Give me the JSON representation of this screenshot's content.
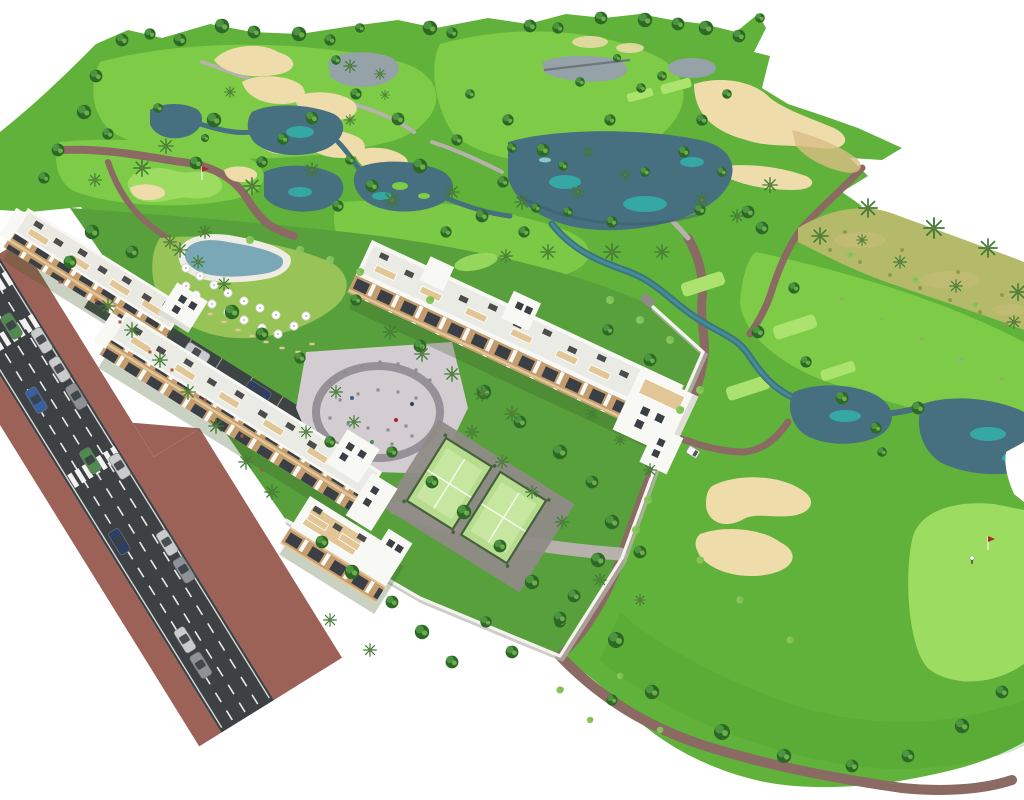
{
  "meta": {
    "description": "Aerial 3D architectural rendering of a white apartment resort complex with pool, playground and padel courts beside a golf course with lakes, sand bunkers, palm trees and an access road with cars"
  },
  "colors": {
    "bg": "#ffffff",
    "grassBase": "#61b23a",
    "grassLight": "#7ecb47",
    "grassPale": "#9cdc60",
    "tee": "#abe36e",
    "grassDark": "#4a9a2f",
    "grassComplex": "#57a03c",
    "lawnYellow": "#a3c95c",
    "scrub": "#b4ba6a",
    "scrubDark": "#8d9a4d",
    "lake": "#46707f",
    "lakeDark": "#3a5c6d",
    "lakeTeal": "#35a7a4",
    "lakeLight": "#86ccc9",
    "pondGray": "#95a3a8",
    "sand": "#eedcab",
    "sandDark": "#d9bd85",
    "path": "#8a6a63",
    "pathGray": "#b7b1ac",
    "road": "#3d4144",
    "roadLine": "#f2f2f0",
    "sidewalk": "#9c6257",
    "bld": "#f8f8f4",
    "bldShade": "#deded6",
    "balconyTan": "#c59c6e",
    "balconyLight": "#e3c695",
    "glass": "#3a3f45",
    "roofItem": "#4c4c4a",
    "wall": "#f4f3ee",
    "wallShadow": "#b9b8b0",
    "pave": "#d3ccd1",
    "paveArc": "#8f8a91",
    "paveDark": "#8f8b86",
    "padel": "#b7dc8d",
    "padelLight": "#cdeaa8",
    "fence": "#44603e",
    "pool": "#7ba8b6",
    "deck": "#efece3",
    "shadow": "rgba(60,90,40,0.28)",
    "treeDark": "#2d6827",
    "treeMid": "#4c9440",
    "treeLight": "#7cbf53",
    "palm": "#3e7c33",
    "trunk": "#8a6b4a",
    "bush": "#8ac45d",
    "carSilver": "#c9cbcd",
    "carGray": "#8e9296",
    "carBlue": "#3a5f9e",
    "carDarkBlue": "#2e3f63",
    "carGreen": "#4f8a4e",
    "cartWhite": "#fafafa",
    "flag": "#a32c24",
    "figure": "#a85a3c",
    "speck": "#8d8894",
    "bridge": "#70757a"
  },
  "scene": {
    "trees_round": [
      [
        122,
        40,
        0.8
      ],
      [
        150,
        34,
        0.7
      ],
      [
        180,
        40,
        0.8
      ],
      [
        222,
        26,
        0.9
      ],
      [
        254,
        32,
        0.8
      ],
      [
        299,
        34,
        0.9
      ],
      [
        330,
        40,
        0.7
      ],
      [
        360,
        28,
        0.6
      ],
      [
        430,
        28,
        0.9
      ],
      [
        452,
        33,
        0.7
      ],
      [
        530,
        26,
        0.8
      ],
      [
        558,
        28,
        0.7
      ],
      [
        601,
        18,
        0.8
      ],
      [
        645,
        20,
        0.9
      ],
      [
        678,
        24,
        0.8
      ],
      [
        706,
        28,
        0.9
      ],
      [
        739,
        36,
        0.8
      ],
      [
        760,
        18,
        0.6
      ],
      [
        96,
        76,
        0.8
      ],
      [
        84,
        112,
        0.9
      ],
      [
        58,
        150,
        0.8
      ],
      [
        44,
        178,
        0.7
      ],
      [
        108,
        134,
        0.7
      ],
      [
        214,
        120,
        0.9
      ],
      [
        196,
        163,
        0.8
      ],
      [
        283,
        139,
        0.7
      ],
      [
        312,
        118,
        0.8
      ],
      [
        356,
        94,
        0.7
      ],
      [
        398,
        119,
        0.8
      ],
      [
        420,
        166,
        0.9
      ],
      [
        457,
        140,
        0.7
      ],
      [
        372,
        186,
        0.8
      ],
      [
        338,
        206,
        0.7
      ],
      [
        470,
        94,
        0.6
      ],
      [
        508,
        120,
        0.7
      ],
      [
        543,
        150,
        0.8
      ],
      [
        503,
        182,
        0.7
      ],
      [
        563,
        166,
        0.6
      ],
      [
        610,
        120,
        0.7
      ],
      [
        641,
        88,
        0.6
      ],
      [
        580,
        82,
        0.6
      ],
      [
        617,
        58,
        0.5
      ],
      [
        662,
        76,
        0.6
      ],
      [
        702,
        120,
        0.7
      ],
      [
        727,
        94,
        0.6
      ],
      [
        684,
        152,
        0.7
      ],
      [
        722,
        172,
        0.6
      ],
      [
        748,
        212,
        0.8
      ],
      [
        645,
        172,
        0.6
      ],
      [
        612,
        222,
        0.7
      ],
      [
        568,
        212,
        0.6
      ],
      [
        524,
        232,
        0.7
      ],
      [
        482,
        216,
        0.8
      ],
      [
        446,
        232,
        0.7
      ],
      [
        762,
        228,
        0.8
      ],
      [
        794,
        288,
        0.7
      ],
      [
        758,
        332,
        0.8
      ],
      [
        806,
        362,
        0.7
      ],
      [
        842,
        398,
        0.8
      ],
      [
        876,
        428,
        0.7
      ],
      [
        918,
        408,
        0.8
      ],
      [
        882,
        452,
        0.6
      ],
      [
        512,
        148,
        0.6
      ],
      [
        536,
        208,
        0.6
      ],
      [
        700,
        210,
        0.7
      ],
      [
        350,
        160,
        0.6
      ],
      [
        262,
        162,
        0.7
      ],
      [
        158,
        108,
        0.6
      ],
      [
        205,
        138,
        0.5
      ],
      [
        336,
        60,
        0.6
      ],
      [
        598,
        560,
        0.9
      ],
      [
        574,
        596,
        0.8
      ],
      [
        616,
        640,
        1.0
      ],
      [
        652,
        692,
        0.9
      ],
      [
        722,
        732,
        1.0
      ],
      [
        784,
        756,
        0.9
      ],
      [
        852,
        766,
        0.8
      ],
      [
        908,
        756,
        0.8
      ],
      [
        962,
        726,
        0.9
      ],
      [
        1002,
        692,
        0.8
      ],
      [
        612,
        700,
        0.7
      ],
      [
        560,
        622,
        0.7
      ],
      [
        92,
        232,
        0.9
      ],
      [
        70,
        262,
        0.8
      ],
      [
        132,
        252,
        0.8
      ],
      [
        232,
        312,
        0.9
      ],
      [
        262,
        334,
        0.8
      ],
      [
        356,
        300,
        0.7
      ],
      [
        420,
        346,
        0.8
      ],
      [
        484,
        392,
        0.9
      ],
      [
        520,
        422,
        0.8
      ],
      [
        560,
        452,
        0.9
      ],
      [
        592,
        482,
        0.8
      ],
      [
        612,
        522,
        0.9
      ],
      [
        640,
        552,
        0.8
      ],
      [
        432,
        482,
        0.8
      ],
      [
        464,
        512,
        0.9
      ],
      [
        500,
        546,
        0.8
      ],
      [
        532,
        582,
        0.9
      ],
      [
        560,
        618,
        0.8
      ],
      [
        330,
        442,
        0.7
      ],
      [
        392,
        452,
        0.7
      ],
      [
        322,
        542,
        0.8
      ],
      [
        352,
        572,
        0.9
      ],
      [
        392,
        602,
        0.8
      ],
      [
        422,
        632,
        0.9
      ],
      [
        452,
        662,
        0.8
      ],
      [
        486,
        622,
        0.7
      ],
      [
        512,
        652,
        0.8
      ],
      [
        300,
        358,
        0.7
      ],
      [
        608,
        330,
        0.7
      ],
      [
        650,
        360,
        0.8
      ]
    ],
    "trees_palm": [
      [
        252,
        186,
        0.9
      ],
      [
        312,
        170,
        0.8
      ],
      [
        392,
        200,
        0.9
      ],
      [
        452,
        192,
        0.8
      ],
      [
        522,
        202,
        0.8
      ],
      [
        578,
        192,
        0.7
      ],
      [
        612,
        252,
        0.9
      ],
      [
        662,
        252,
        0.8
      ],
      [
        702,
        200,
        0.8
      ],
      [
        737,
        216,
        0.7
      ],
      [
        548,
        252,
        0.8
      ],
      [
        506,
        256,
        0.7
      ],
      [
        166,
        146,
        0.8
      ],
      [
        142,
        168,
        0.9
      ],
      [
        180,
        250,
        0.8
      ],
      [
        205,
        232,
        0.7
      ],
      [
        95,
        180,
        0.7
      ],
      [
        230,
        92,
        0.6
      ],
      [
        350,
        120,
        0.6
      ],
      [
        385,
        95,
        0.5
      ],
      [
        588,
        152,
        0.6
      ],
      [
        625,
        175,
        0.6
      ],
      [
        770,
        185,
        0.8
      ],
      [
        350,
        66,
        0.7
      ],
      [
        380,
        74,
        0.6
      ],
      [
        820,
        236,
        0.9
      ],
      [
        868,
        208,
        1.0
      ],
      [
        934,
        228,
        1.1
      ],
      [
        988,
        248,
        1.0
      ],
      [
        1018,
        292,
        0.9
      ],
      [
        900,
        262,
        0.7
      ],
      [
        956,
        286,
        0.7
      ],
      [
        1014,
        322,
        0.7
      ],
      [
        862,
        240,
        0.6
      ],
      [
        108,
        306,
        0.8
      ],
      [
        132,
        330,
        0.8
      ],
      [
        160,
        360,
        0.8
      ],
      [
        188,
        392,
        0.8
      ],
      [
        216,
        426,
        0.8
      ],
      [
        246,
        462,
        0.8
      ],
      [
        272,
        492,
        0.8
      ],
      [
        170,
        242,
        0.7
      ],
      [
        198,
        262,
        0.7
      ],
      [
        224,
        284,
        0.7
      ],
      [
        390,
        332,
        0.8
      ],
      [
        422,
        354,
        0.8
      ],
      [
        452,
        374,
        0.8
      ],
      [
        482,
        394,
        0.8
      ],
      [
        512,
        414,
        0.8
      ],
      [
        336,
        392,
        0.7
      ],
      [
        354,
        422,
        0.7
      ],
      [
        306,
        432,
        0.7
      ],
      [
        472,
        432,
        0.7
      ],
      [
        502,
        462,
        0.7
      ],
      [
        532,
        492,
        0.7
      ],
      [
        562,
        522,
        0.7
      ],
      [
        592,
        414,
        0.6
      ],
      [
        620,
        440,
        0.6
      ],
      [
        650,
        470,
        0.7
      ],
      [
        600,
        580,
        0.7
      ],
      [
        640,
        600,
        0.6
      ],
      [
        330,
        620,
        0.7
      ],
      [
        370,
        650,
        0.7
      ]
    ],
    "bushes": [
      [
        300,
        250,
        1
      ],
      [
        330,
        260,
        1
      ],
      [
        360,
        272,
        1
      ],
      [
        430,
        300,
        1
      ],
      [
        250,
        240,
        1
      ],
      [
        610,
        300,
        1
      ],
      [
        640,
        320,
        1
      ],
      [
        670,
        340,
        1
      ],
      [
        700,
        390,
        1
      ],
      [
        680,
        410,
        1
      ],
      [
        648,
        500,
        1
      ],
      [
        636,
        530,
        1
      ],
      [
        700,
        560,
        0.9
      ],
      [
        740,
        600,
        0.9
      ],
      [
        790,
        640,
        0.9
      ],
      [
        560,
        690,
        0.9
      ],
      [
        620,
        676,
        0.8
      ],
      [
        840,
        300,
        0.8
      ],
      [
        880,
        320,
        0.8
      ],
      [
        920,
        340,
        0.8
      ],
      [
        960,
        360,
        0.8
      ],
      [
        1000,
        380,
        0.8
      ],
      [
        850,
        255,
        0.7
      ],
      [
        915,
        280,
        0.7
      ],
      [
        975,
        305,
        0.7
      ],
      [
        590,
        720,
        0.8
      ],
      [
        660,
        730,
        0.8
      ]
    ],
    "scrub_dots": [
      [
        830,
        250
      ],
      [
        860,
        262
      ],
      [
        890,
        275
      ],
      [
        920,
        288
      ],
      [
        950,
        300
      ],
      [
        980,
        312
      ],
      [
        1006,
        324
      ],
      [
        845,
        232
      ],
      [
        902,
        250
      ],
      [
        958,
        272
      ],
      [
        1002,
        295
      ]
    ],
    "umbrellas": [
      [
        186,
        268
      ],
      [
        200,
        276
      ],
      [
        214,
        285
      ],
      [
        228,
        293
      ],
      [
        244,
        301
      ],
      [
        260,
        308
      ],
      [
        276,
        315
      ],
      [
        196,
        295
      ],
      [
        212,
        304
      ],
      [
        228,
        312
      ],
      [
        244,
        320
      ],
      [
        262,
        328
      ],
      [
        278,
        334
      ],
      [
        294,
        326
      ],
      [
        306,
        316
      ],
      [
        186,
        286
      ]
    ],
    "loungers": [
      [
        238,
        330
      ],
      [
        252,
        336
      ],
      [
        266,
        342
      ],
      [
        282,
        348
      ],
      [
        298,
        352
      ],
      [
        312,
        344
      ],
      [
        224,
        322
      ],
      [
        210,
        314
      ]
    ],
    "cars_road": [
      [
        92,
        8,
        "carSilver"
      ],
      [
        126,
        8,
        "carSilver"
      ],
      [
        158,
        8,
        "carGray"
      ],
      [
        240,
        8,
        "carSilver"
      ],
      [
        330,
        8,
        "carSilver"
      ],
      [
        362,
        8,
        "carGray"
      ],
      [
        422,
        44,
        "carSilver"
      ],
      [
        452,
        44,
        "carGray"
      ],
      [
        64,
        26,
        "carGreen"
      ],
      [
        220,
        30,
        "carGreen"
      ],
      [
        140,
        44,
        "carBlue"
      ],
      [
        304,
        48,
        "carDarkBlue"
      ]
    ],
    "cars_parking": [
      [
        48,
        9,
        "carGray"
      ],
      [
        120,
        9,
        "carSilver"
      ],
      [
        192,
        9,
        "carDarkBlue"
      ]
    ],
    "crosswalks": [
      [
        14,
        2
      ],
      [
        64,
        2
      ],
      [
        220,
        2
      ]
    ],
    "tee_boxes": [
      [
        703,
        284,
        -18,
        1
      ],
      [
        795,
        327,
        -18,
        1
      ],
      [
        838,
        371,
        -18,
        0.8
      ],
      [
        748,
        388,
        -18,
        1
      ],
      [
        676,
        86,
        -15,
        0.7
      ],
      [
        640,
        95,
        -15,
        0.6
      ]
    ],
    "play_speckles": [
      [
        330,
        382
      ],
      [
        345,
        372
      ],
      [
        362,
        366
      ],
      [
        380,
        362
      ],
      [
        398,
        364
      ],
      [
        416,
        370
      ],
      [
        430,
        380
      ],
      [
        340,
        400
      ],
      [
        358,
        394
      ],
      [
        378,
        390
      ],
      [
        398,
        392
      ],
      [
        416,
        398
      ],
      [
        330,
        418
      ],
      [
        348,
        424
      ],
      [
        368,
        428
      ],
      [
        388,
        430
      ],
      [
        406,
        426
      ],
      [
        352,
        444
      ],
      [
        372,
        448
      ],
      [
        392,
        444
      ],
      [
        412,
        436
      ],
      [
        336,
        458
      ]
    ],
    "play_dots": [
      [
        352,
        398,
        "carBlue"
      ],
      [
        396,
        420,
        "flag"
      ],
      [
        372,
        442,
        "carGreen"
      ],
      [
        412,
        404,
        "carDarkBlue"
      ]
    ],
    "figures": [
      [
        96,
        300
      ],
      [
        120,
        322
      ],
      [
        150,
        352
      ],
      [
        172,
        370
      ],
      [
        205,
        400
      ],
      [
        242,
        436
      ],
      [
        262,
        470
      ],
      [
        60,
        282
      ]
    ],
    "flags": [
      [
        202,
        180
      ],
      [
        988,
        550
      ]
    ],
    "block_a_roof": [
      [
        18,
        9
      ],
      [
        44,
        13
      ],
      [
        70,
        9
      ],
      [
        96,
        13
      ],
      [
        122,
        9
      ],
      [
        148,
        13
      ],
      [
        170,
        9
      ]
    ],
    "block_a_pergolas": [
      [
        24,
        19
      ],
      [
        72,
        19
      ],
      [
        120,
        19
      ],
      [
        158,
        19
      ]
    ],
    "block_b_roof": [
      [
        20,
        10
      ],
      [
        50,
        14
      ],
      [
        80,
        10
      ],
      [
        110,
        14
      ],
      [
        140,
        10
      ],
      [
        170,
        14
      ],
      [
        200,
        10
      ],
      [
        228,
        14
      ],
      [
        256,
        10
      ]
    ],
    "block_b_pergolas": [
      [
        30,
        20
      ],
      [
        82,
        20
      ],
      [
        134,
        20
      ],
      [
        186,
        20
      ],
      [
        238,
        20
      ]
    ],
    "block_c_roof": [
      [
        18,
        10
      ],
      [
        48,
        15
      ],
      [
        78,
        10
      ],
      [
        108,
        15
      ],
      [
        138,
        10
      ],
      [
        168,
        15
      ],
      [
        198,
        10
      ],
      [
        228,
        15
      ],
      [
        258,
        10
      ],
      [
        285,
        15
      ]
    ],
    "block_c_pergolas": [
      [
        26,
        24
      ],
      [
        76,
        24
      ],
      [
        126,
        24
      ],
      [
        176,
        24
      ],
      [
        226,
        24
      ],
      [
        262,
        24
      ]
    ],
    "block_d_roof": [
      [
        14,
        8
      ],
      [
        40,
        12
      ],
      [
        66,
        8
      ]
    ],
    "block_d_pergolas": [
      [
        20,
        18
      ],
      [
        58,
        18
      ]
    ]
  }
}
